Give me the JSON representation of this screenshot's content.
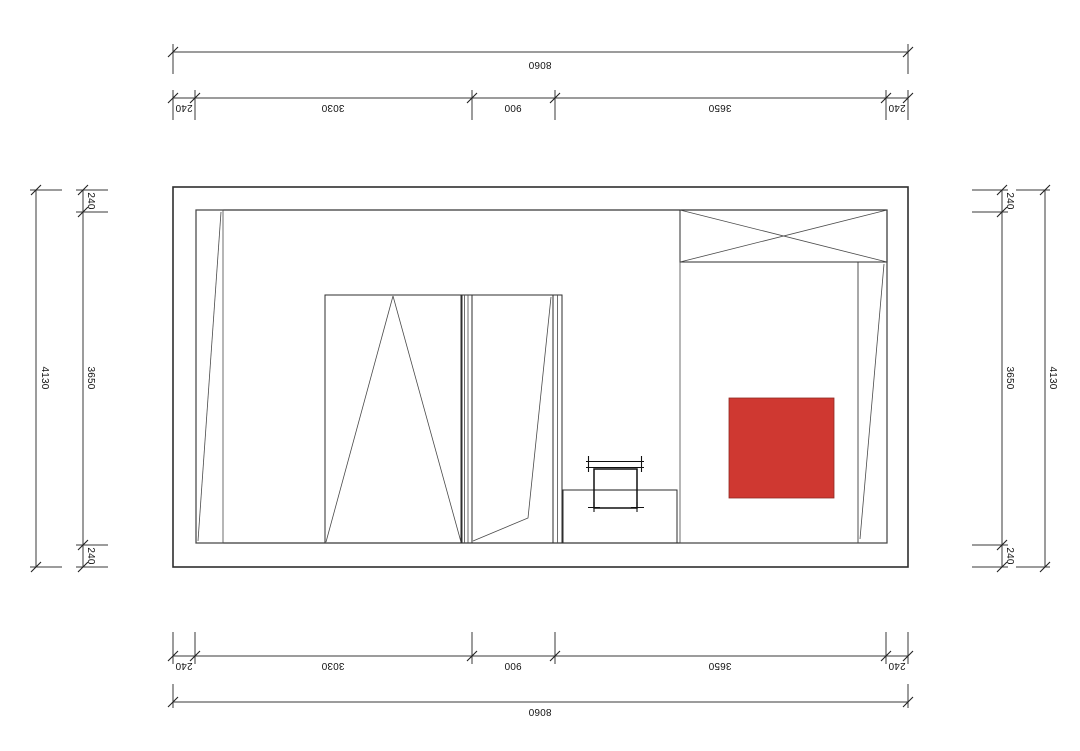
{
  "dimensions": {
    "top": {
      "overall": "8060",
      "segments": [
        "240",
        "3030",
        "900",
        "3650",
        "240"
      ]
    },
    "bottom": {
      "overall": "8060",
      "segments": [
        "240",
        "3030",
        "900",
        "3650",
        "240"
      ]
    },
    "left": {
      "overall": "4130",
      "segments": [
        "240",
        "3650",
        "240"
      ]
    },
    "right": {
      "overall": "4130",
      "segments": [
        "240",
        "3650",
        "240"
      ]
    }
  },
  "colors": {
    "wall": "#7d7d7d",
    "floor": "#e8eaef",
    "beige": "#ded6c3",
    "panel_white": "#ffffff",
    "accent_blue": "#1533b6",
    "accent_red": "#cf3831"
  }
}
